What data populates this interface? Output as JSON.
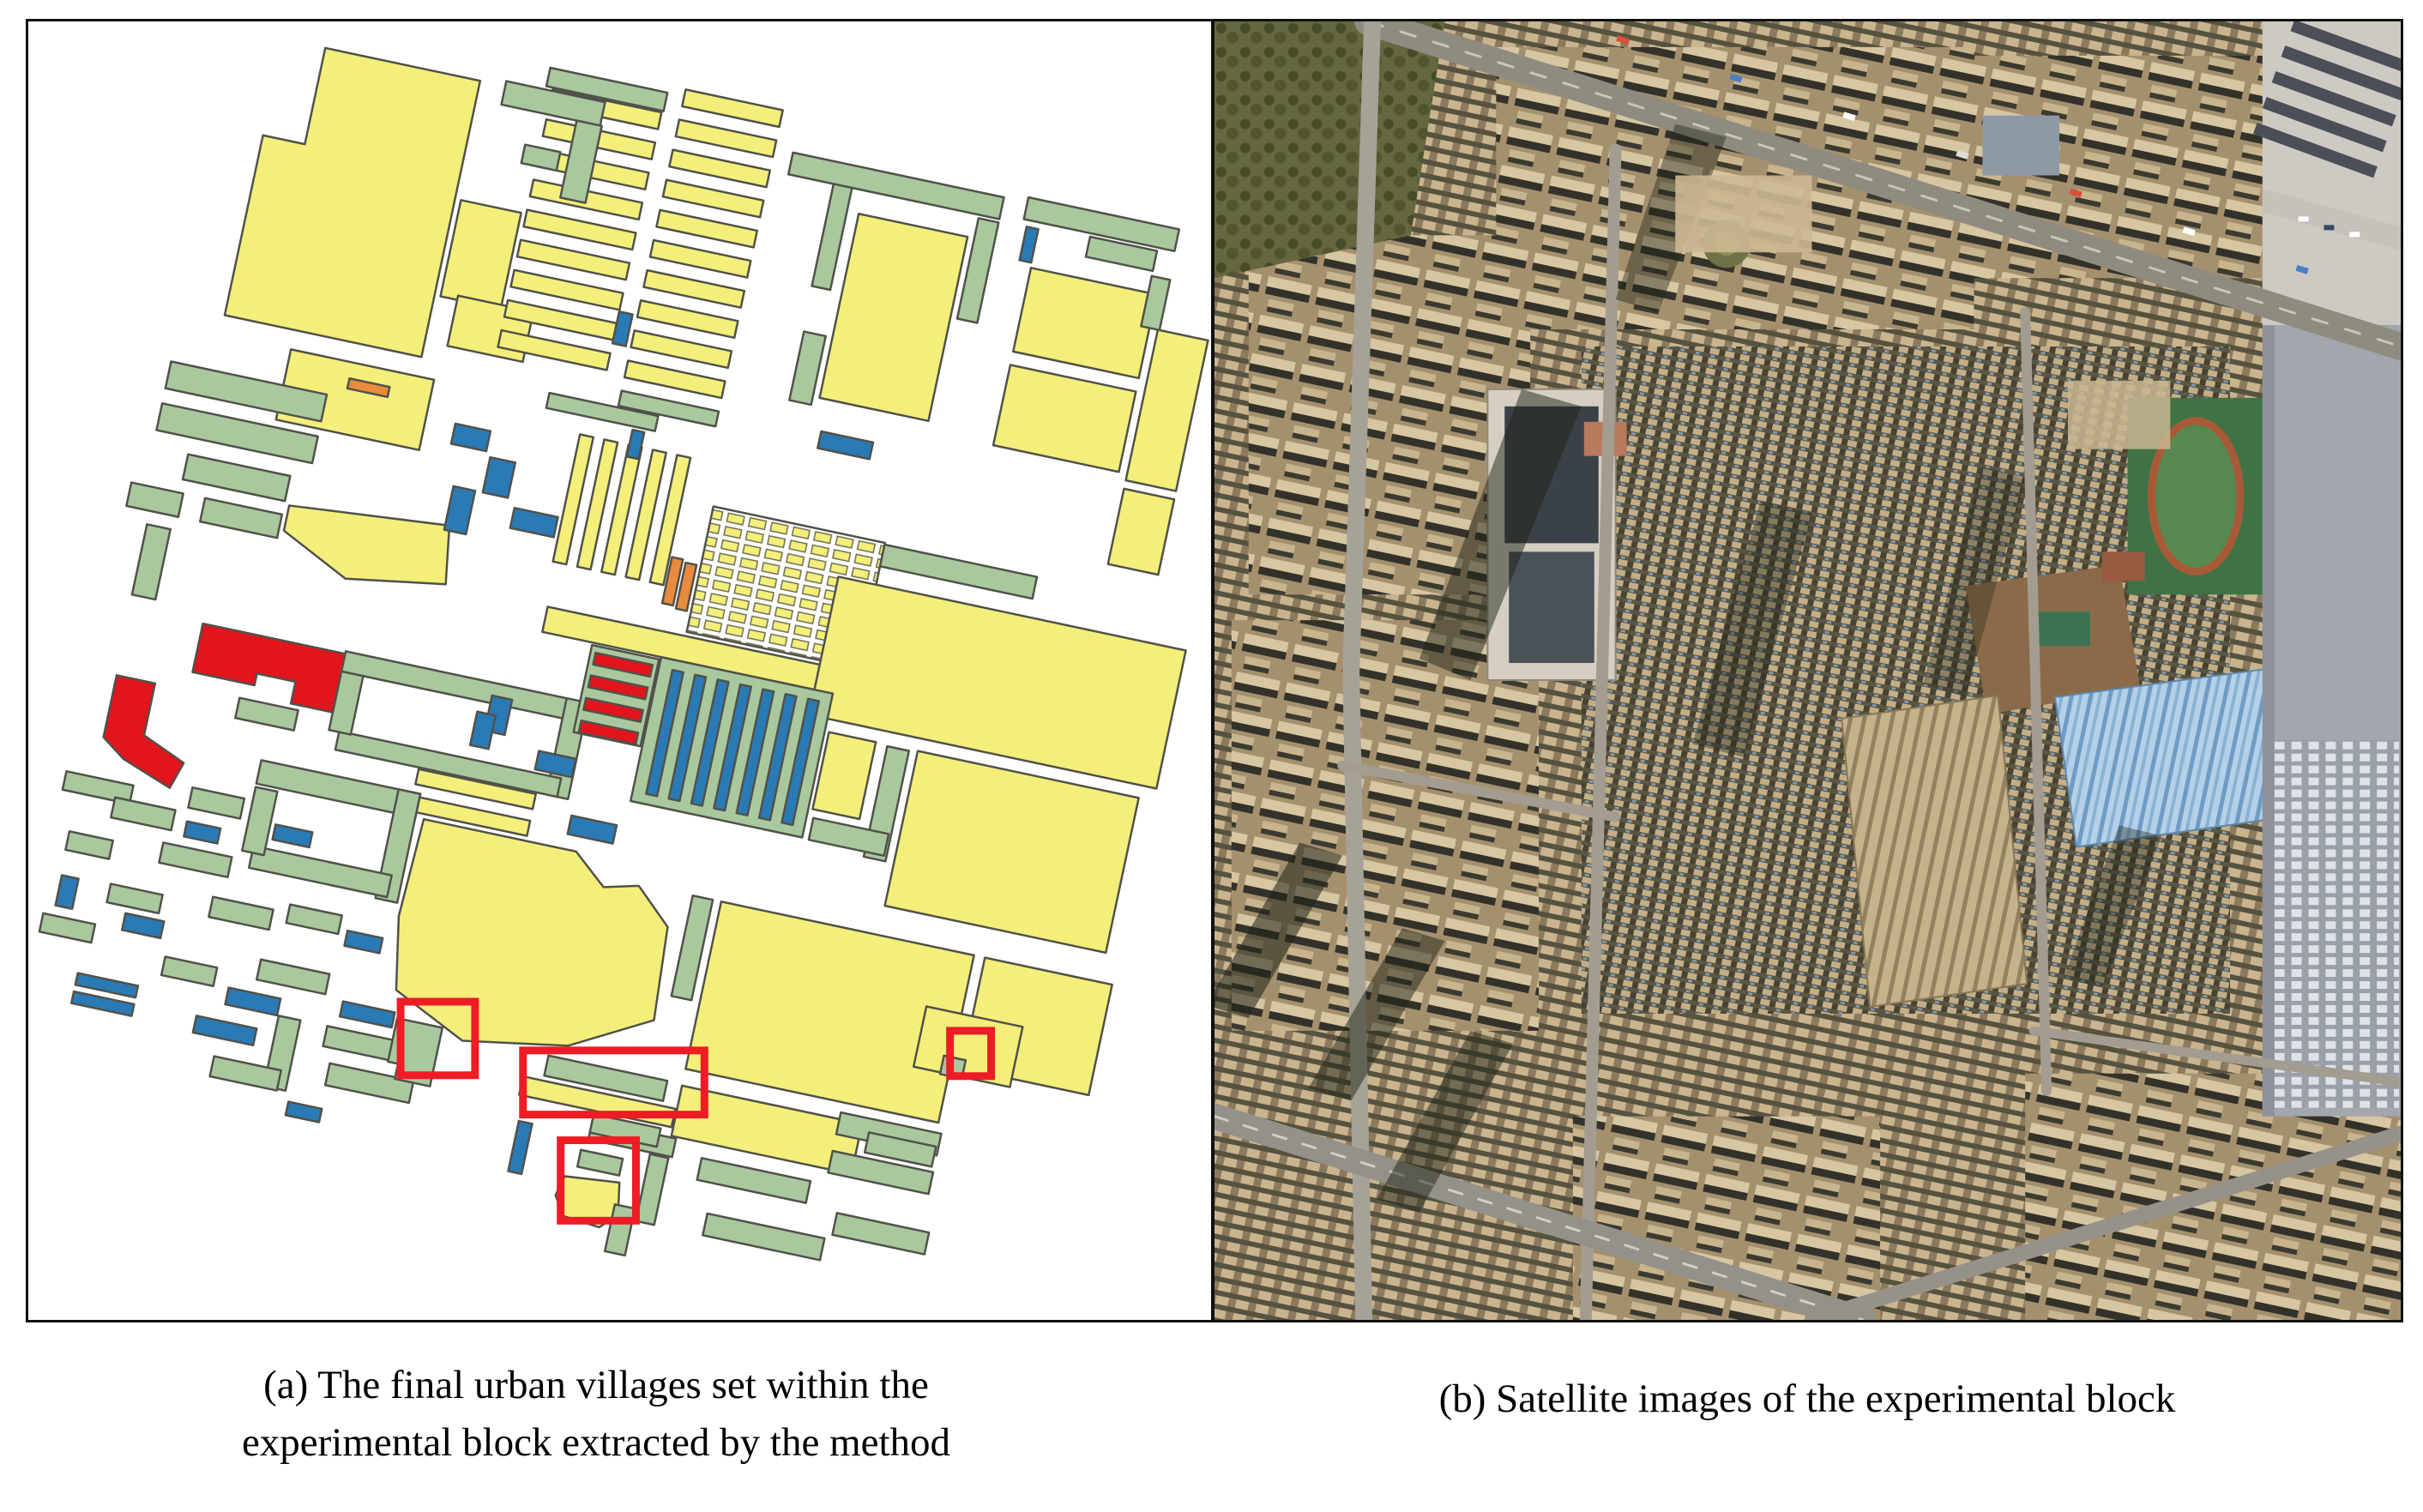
{
  "figure": {
    "panel_a": {
      "caption_line1": "(a) The final urban villages set within the",
      "caption_line2": "experimental block extracted by the method"
    },
    "panel_b": {
      "caption": "(b) Satellite images of the experimental block"
    },
    "annotations": {
      "red_highlight_box_count": 4
    }
  },
  "palette": {
    "urban_village": "#f3ef7a",
    "building_green": "#a9c89e",
    "building_blue": "#2a7ab5",
    "building_red": "#e2141c",
    "building_orange": "#e88b3e",
    "outline": "#51514a",
    "highlight_red": "#ee1c24",
    "panel_border": "#111111",
    "satellite_base": "#b29a77"
  }
}
